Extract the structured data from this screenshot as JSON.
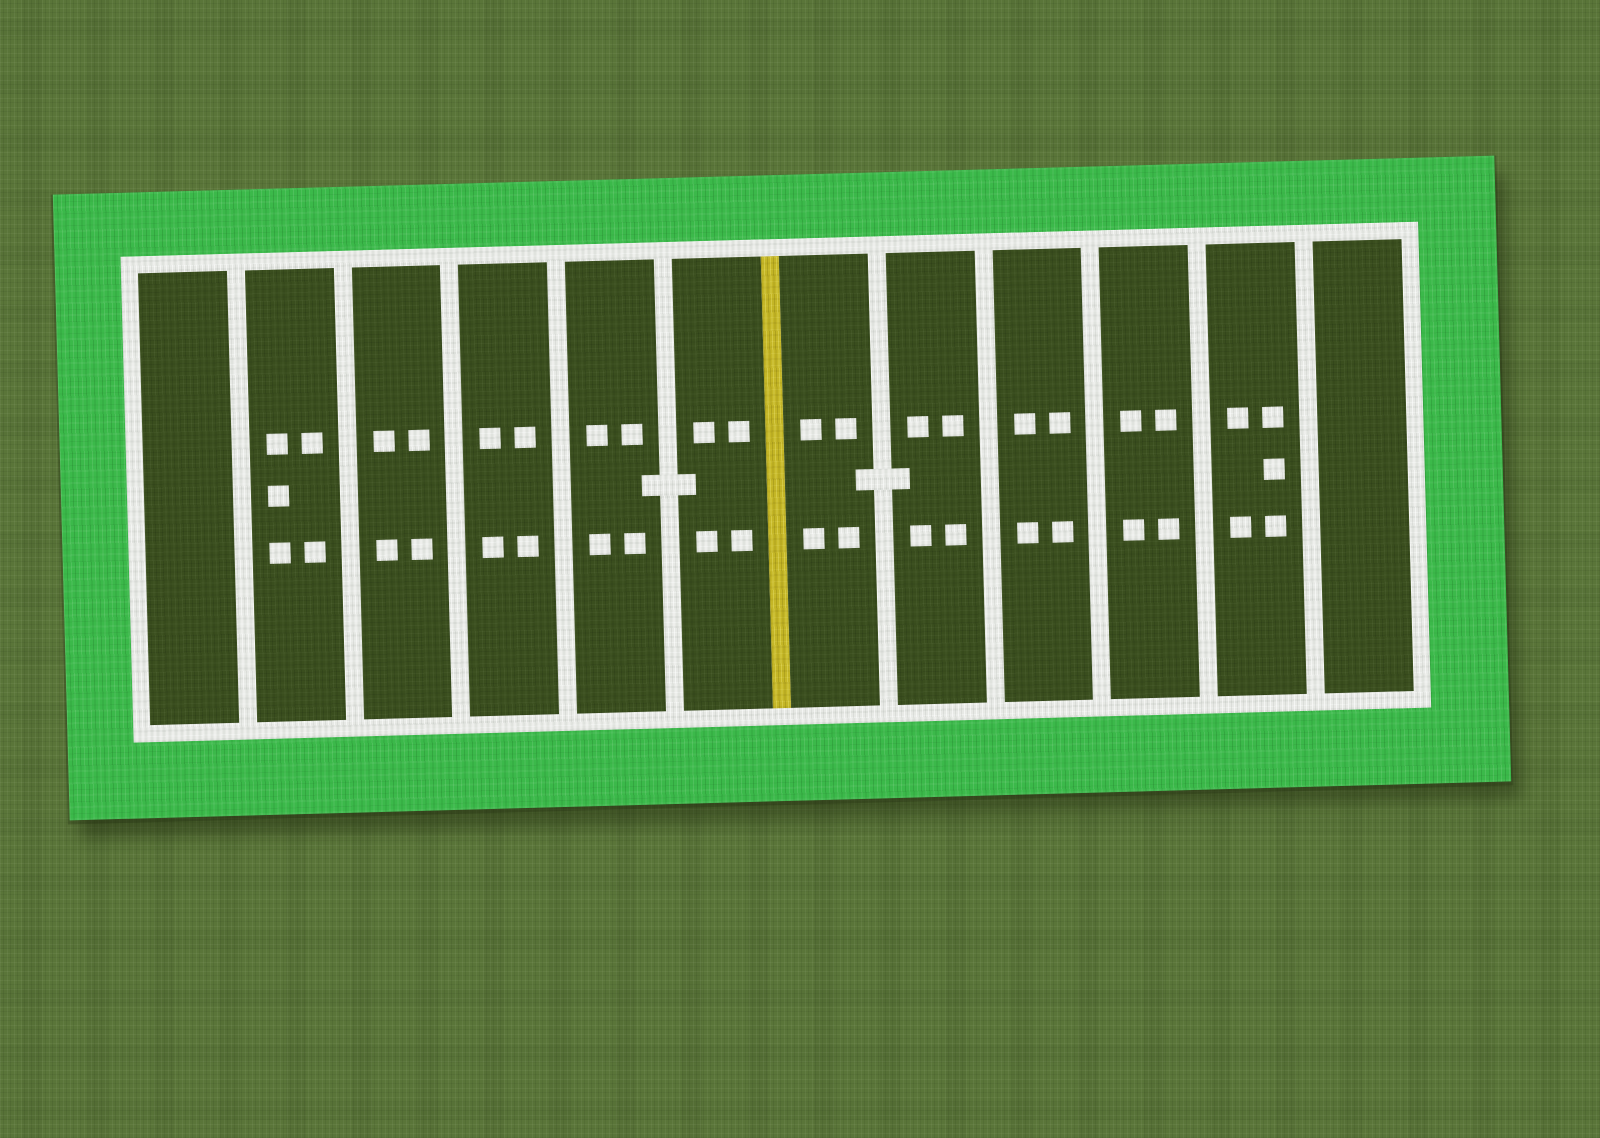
{
  "scene": {
    "description": "Top-down pixel-block view of an American football field built on a grassy plain; no HUD, menus or text visible"
  },
  "colors": {
    "grass_plain": "#5a7539",
    "sideline_apron": "#3bb94a",
    "field_turf": "#3a4e1e",
    "field_lines": "#e7e9e5",
    "midfield_line": "#c4b626"
  },
  "field": {
    "end_zones": 2,
    "segments_between_goal_lines": 10,
    "yard_lines": 11,
    "midfield_line_index": 5,
    "hash_mark_rows": 2,
    "hash_marks_per_segment_per_row": 2,
    "cross_marked_line_indices": [
      4,
      6
    ],
    "single_mid_marks": [
      {
        "segment_index": 0,
        "column": 0
      },
      {
        "segment_index": 9,
        "column": 1
      }
    ]
  }
}
